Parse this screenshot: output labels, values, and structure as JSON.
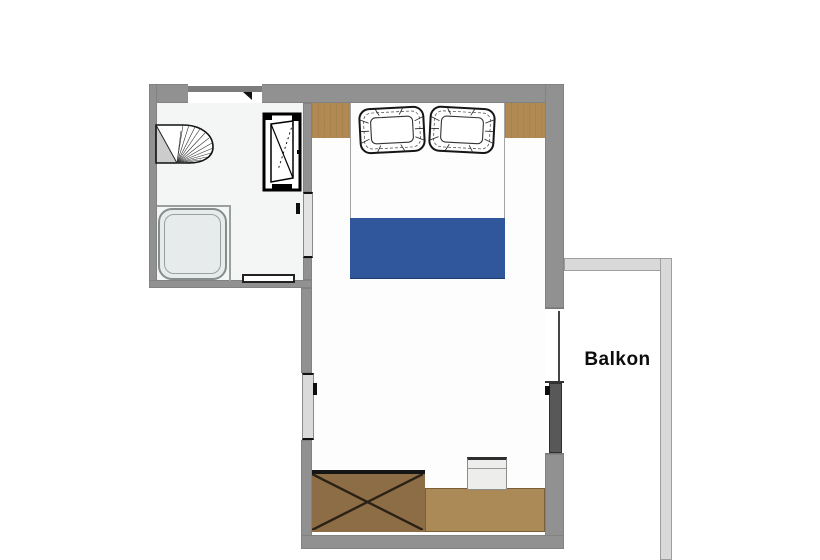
{
  "rooms": {
    "bathroom": {
      "name": "bathroom"
    },
    "bedroom": {
      "name": "bedroom"
    },
    "balcony": {
      "name": "balcony",
      "label": "Balkon"
    }
  },
  "objects": [
    "bathroom-window",
    "washbasin",
    "shower-tray",
    "tilt-window-frame",
    "bathroom-door",
    "door-sill",
    "double-bed",
    "pillow-left",
    "pillow-right",
    "blanket",
    "bedside-cabinet-left",
    "bedside-cabinet-right",
    "interior-door",
    "balcony-door",
    "wardrobe",
    "desk",
    "chair",
    "balcony-railing"
  ],
  "colors": {
    "wall": "#919191",
    "floor": "#fdfdfd",
    "bathroom_floor": "#f4f5f5",
    "wood_cabinet": "#b18953",
    "wood_wardrobe": "#8d6d45",
    "wood_desk": "#ac8a57",
    "bed": "#fdfdfd",
    "blanket": "#30569b",
    "rail": "#d9d9d9",
    "rail_edge": "#9e9e9e",
    "door_leaf": "#e3e3e3",
    "balcony_leaf": "#585858",
    "shower": "#e8ebeb",
    "chair": "#ededeb"
  }
}
